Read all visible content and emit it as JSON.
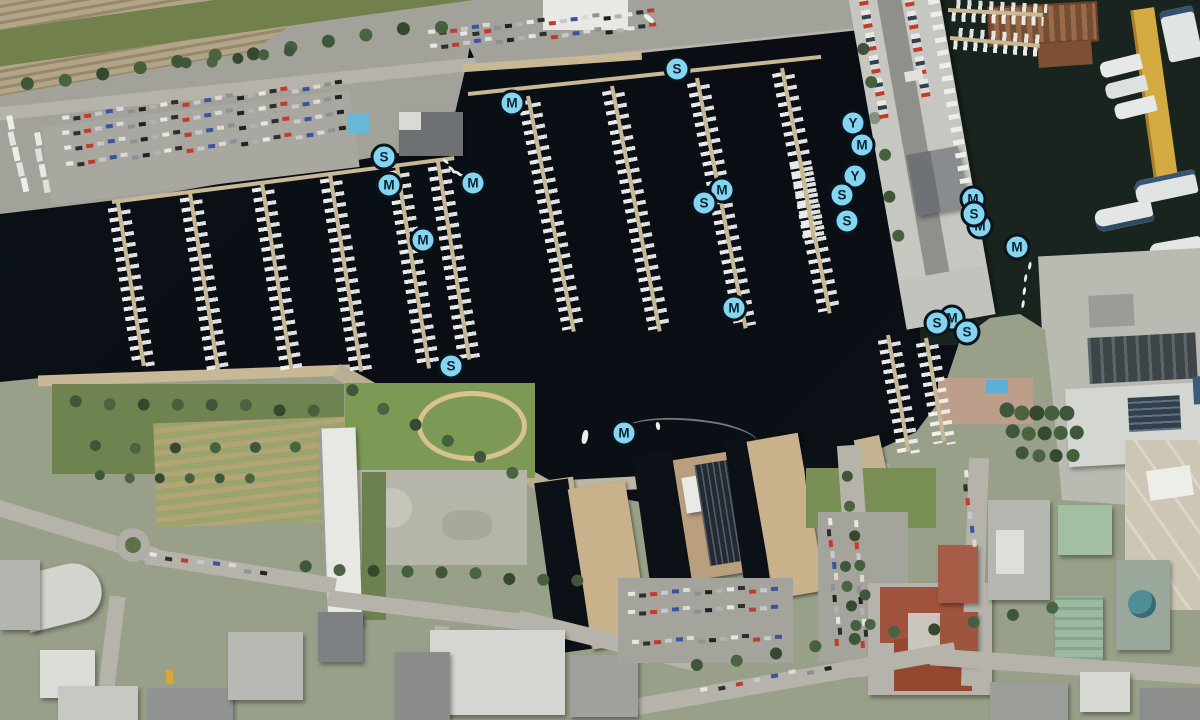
{
  "map": {
    "view_label": "Harbor satellite map with mooring markers",
    "marker_colors": {
      "fill": "#84d5f1",
      "border": "#0a141d",
      "letter": "#0c2230"
    },
    "marker_legend": {
      "S": "S",
      "M": "M",
      "Y": "Y"
    },
    "markers": [
      {
        "letter": "M",
        "x": 980,
        "y": 226
      },
      {
        "letter": "M",
        "x": 973,
        "y": 199
      },
      {
        "letter": "S",
        "x": 974,
        "y": 214
      },
      {
        "letter": "Y",
        "x": 853,
        "y": 123
      },
      {
        "letter": "M",
        "x": 862,
        "y": 145
      },
      {
        "letter": "Y",
        "x": 855,
        "y": 176
      },
      {
        "letter": "S",
        "x": 842,
        "y": 195
      },
      {
        "letter": "S",
        "x": 847,
        "y": 221
      },
      {
        "letter": "M",
        "x": 722,
        "y": 190
      },
      {
        "letter": "S",
        "x": 704,
        "y": 203
      },
      {
        "letter": "S",
        "x": 677,
        "y": 69
      },
      {
        "letter": "M",
        "x": 512,
        "y": 103
      },
      {
        "letter": "S",
        "x": 384,
        "y": 157
      },
      {
        "letter": "M",
        "x": 389,
        "y": 185
      },
      {
        "letter": "M",
        "x": 473,
        "y": 183
      },
      {
        "letter": "M",
        "x": 423,
        "y": 240
      },
      {
        "letter": "M",
        "x": 1017,
        "y": 247
      },
      {
        "letter": "M",
        "x": 952,
        "y": 318
      },
      {
        "letter": "S",
        "x": 937,
        "y": 323
      },
      {
        "letter": "S",
        "x": 967,
        "y": 332
      },
      {
        "letter": "M",
        "x": 734,
        "y": 308
      },
      {
        "letter": "S",
        "x": 451,
        "y": 366
      },
      {
        "letter": "M",
        "x": 624,
        "y": 433
      }
    ]
  }
}
